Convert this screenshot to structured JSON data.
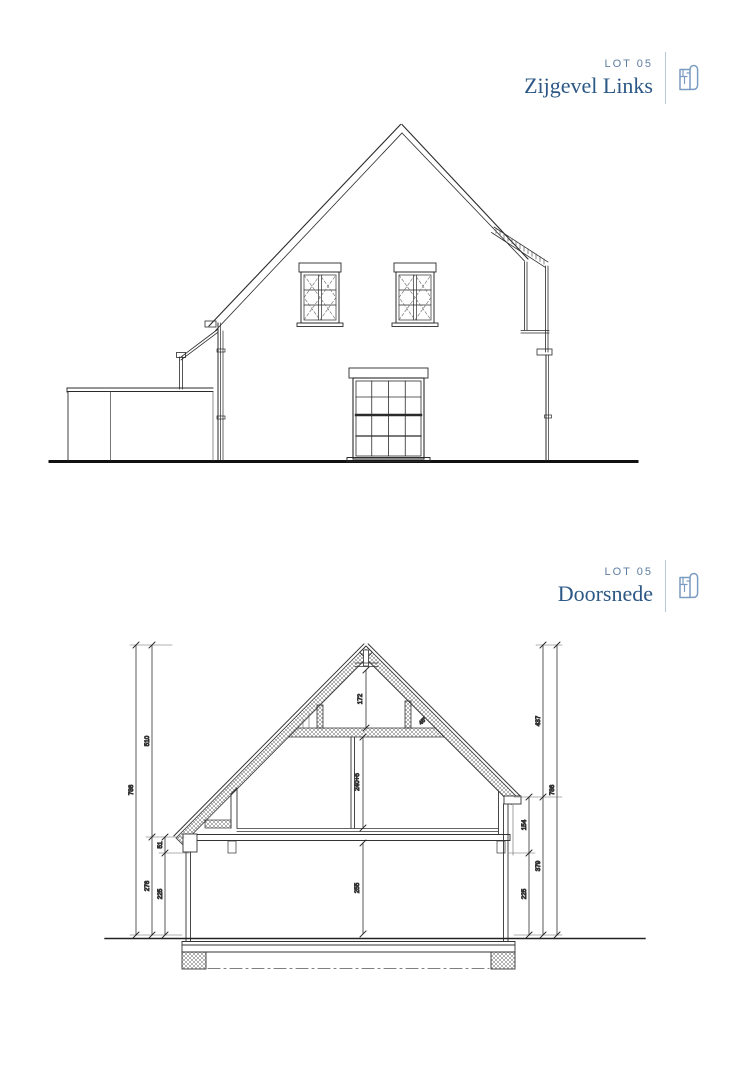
{
  "headers": [
    {
      "lot": "LOT 05",
      "title": "Zijgevel Links"
    },
    {
      "lot": "LOT 05",
      "title": "Doorsnede"
    }
  ],
  "colors": {
    "title_blue": "#2c5886",
    "lot_blue": "#5d7da2",
    "divider_blue": "#b9c8da",
    "icon_blue": "#7b9cc2",
    "line_dark": "#2b2b2b",
    "line_light": "#777777"
  },
  "section": {
    "dims_left": {
      "total": "786",
      "upper": "510",
      "lower": "276",
      "eaves_offset": "51",
      "wall_lower": "225"
    },
    "dims_right": {
      "roof_upper": "437",
      "total": "786",
      "eaves_to_floor": "154",
      "lower": "379",
      "wall_lower": "225"
    },
    "dims_inner": {
      "attic_height": "172",
      "first_floor_height": "240+5",
      "ground_floor_height": "255"
    },
    "roof_angle": "45°"
  }
}
